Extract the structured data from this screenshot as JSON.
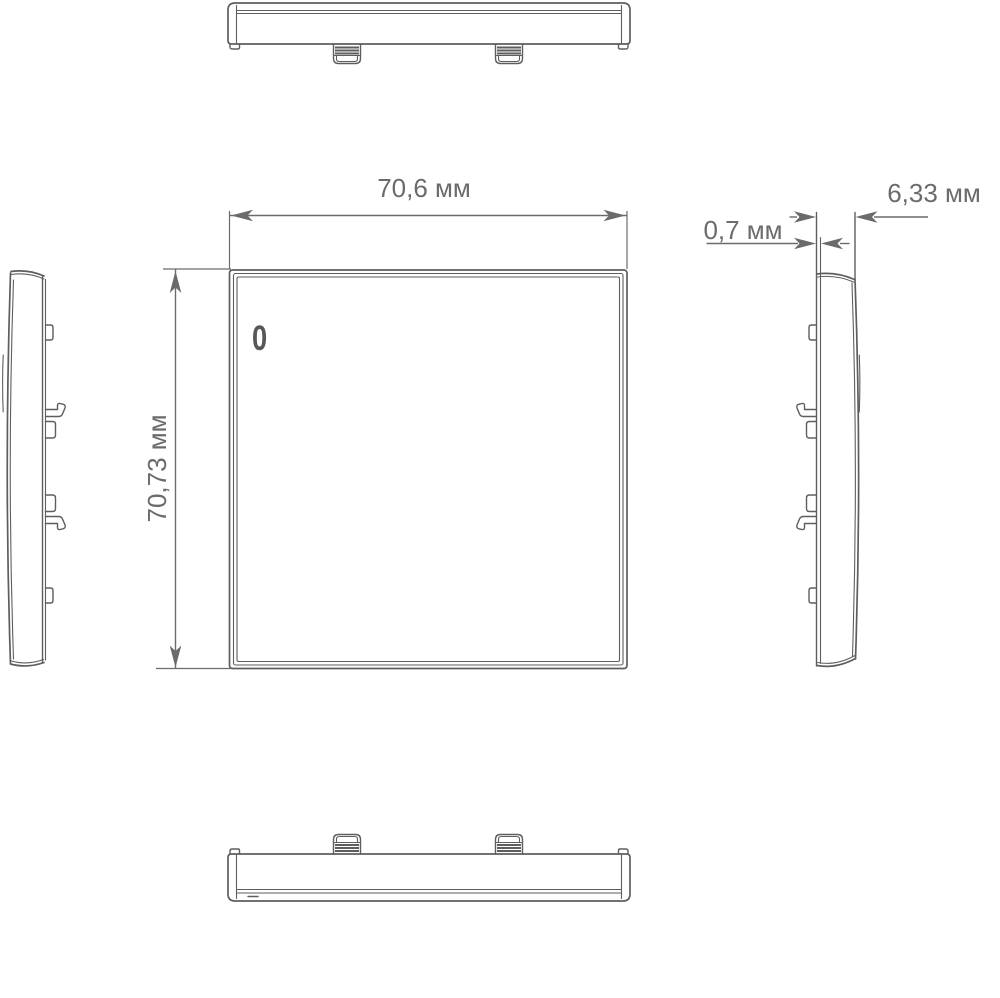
{
  "drawing": {
    "marking_text": "0",
    "unit": "мм",
    "dimensions": {
      "width": {
        "label": "70,6 мм",
        "value_mm": 70.6
      },
      "height": {
        "label": "70,73 мм",
        "value_mm": 70.73
      },
      "front_lip": {
        "label": "0,7 мм",
        "value_mm": 0.7
      },
      "depth": {
        "label": "6,33 мм",
        "value_mm": 6.33
      }
    },
    "colors": {
      "outline": "#5e5e5e",
      "dimension": "#6b6b6b",
      "marking": "#575757",
      "background": "#ffffff"
    }
  }
}
